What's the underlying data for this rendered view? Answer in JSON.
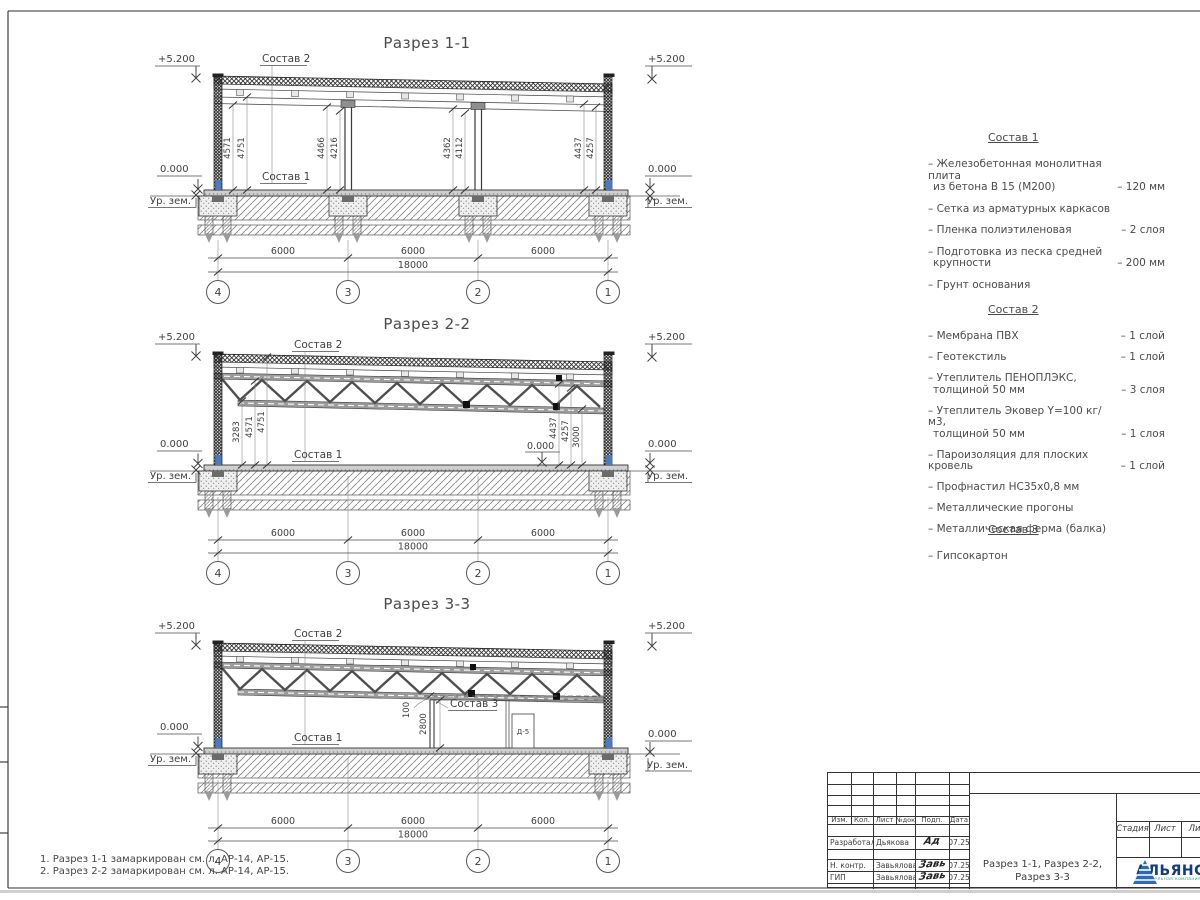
{
  "sections": [
    {
      "title": "Разрез 1-1",
      "sostav2": "Состав 2",
      "sostav1": "Состав 1",
      "lev_top": "+5.200",
      "lev_zero": "0.000",
      "lev_ground": "Ур. зем.",
      "vdims": [
        "4571",
        "4751",
        "4466",
        "4216",
        "4362",
        "4112",
        "4437",
        "4257"
      ],
      "spans": [
        "6000",
        "6000",
        "6000"
      ],
      "total": "18000",
      "axes": [
        "4",
        "3",
        "2",
        "1"
      ]
    },
    {
      "title": "Разрез 2-2",
      "sostav2": "Состав 2",
      "sostav1": "Состав 1",
      "lev_top": "+5.200",
      "lev_zero": "0.000",
      "lev_ground": "Ур. зем.",
      "mid_zero": "0.000",
      "vdims_left": [
        "3283",
        "4571",
        "4751"
      ],
      "vdims_right": [
        "4437",
        "4257",
        "3000"
      ],
      "spans": [
        "6000",
        "6000",
        "6000"
      ],
      "total": "18000",
      "axes": [
        "4",
        "3",
        "2",
        "1"
      ]
    },
    {
      "title": "Разрез 3-3",
      "sostav2": "Состав 2",
      "sostav1": "Состав 1",
      "sostav3": "Состав 3",
      "lev_top": "+5.200",
      "lev_zero": "0.000",
      "lev_ground": "Ур. зем.",
      "dim_gap": "100",
      "dim_wall": "2800",
      "door": "Д-5",
      "spans": [
        "6000",
        "6000",
        "6000"
      ],
      "total": "18000",
      "axes": [
        "4",
        "3",
        "2",
        "1"
      ]
    }
  ],
  "legend": {
    "blocks": [
      {
        "title": "Состав 1",
        "items": [
          {
            "lines": [
              "– Железобетонная  монолитная плита",
              "из бетона В 15 (М200)"
            ],
            "value": "– 120 мм"
          },
          {
            "lines": [
              "– Сетка из арматурных каркасов"
            ],
            "value": ""
          },
          {
            "lines": [
              "– Пленка полиэтиленовая"
            ],
            "value": "– 2 слоя"
          },
          {
            "lines": [
              "– Подготовка из песка средней",
              "крупности"
            ],
            "value": "– 200 мм"
          },
          {
            "lines": [
              "– Грунт основания"
            ],
            "value": ""
          }
        ]
      },
      {
        "title": "Состав 2",
        "items": [
          {
            "lines": [
              "– Мембрана ПВХ"
            ],
            "value": "– 1 слой"
          },
          {
            "lines": [
              "– Геотекстиль"
            ],
            "value": "– 1 слой"
          },
          {
            "lines": [
              "– Утеплитель ПЕНОПЛЭКС,",
              "толщиной 50 мм"
            ],
            "value": "– 3 слоя"
          },
          {
            "lines": [
              "– Утеплитель Эковер Y=100 кг/м3,",
              "толщиной 50 мм"
            ],
            "value": "– 1 слоя"
          },
          {
            "lines": [
              "– Пароизоляция для плоских кровель"
            ],
            "value": "– 1 слой"
          },
          {
            "lines": [
              "– Профнастил НС35х0,8 мм"
            ],
            "value": ""
          },
          {
            "lines": [
              "– Металлические прогоны"
            ],
            "value": ""
          },
          {
            "lines": [
              "– Металлическая ферма (балка)"
            ],
            "value": ""
          }
        ]
      },
      {
        "title": "Состав 3",
        "items": [
          {
            "lines": [
              "– Гипсокартон"
            ],
            "value": ""
          }
        ]
      }
    ]
  },
  "notes": [
    "1. Разрез 1-1 замаркирован см. л. АР-14, АР-15.",
    "2. Разрез 2-2 замаркирован см. л. АР-14, АР-15."
  ],
  "titleblock": {
    "cols": [
      "Изм.",
      "Кол.",
      "Лист",
      "№док",
      "Подп.",
      "Дата"
    ],
    "rows": [
      {
        "role": "Разработал",
        "name": "Дьякова",
        "sig": "Ад",
        "date": "07.25"
      },
      {
        "role": "Н. контр.",
        "name": "Завьялова",
        "sig": "Завь",
        "date": "07.25"
      },
      {
        "role": "ГИП",
        "name": "Завьялова",
        "sig": "Завь",
        "date": "07.25"
      }
    ],
    "doc1": "Разрез 1-1, Разрез 2-2,",
    "doc2": "Разрез 3-3",
    "stage": [
      "Стадия",
      "Лист",
      "Листов"
    ],
    "logo": {
      "text": "АЛЬЯНС",
      "sub": "строительная компания"
    }
  }
}
